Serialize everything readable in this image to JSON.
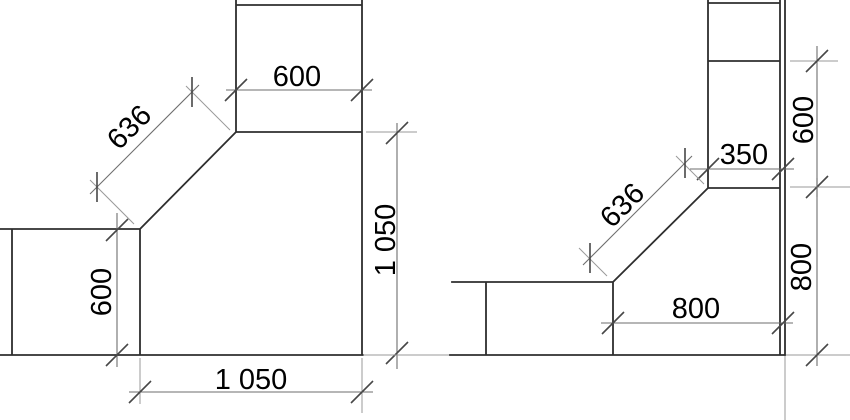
{
  "colors": {
    "background": "#ffffff",
    "object_line": "#2e2e2e",
    "dimension_line": "#6e6e6e",
    "tick": "#474747",
    "extension_line": "#9a9a9a",
    "text": "#000000"
  },
  "views": {
    "left": {
      "dims": {
        "top_width": "600",
        "diagonal": "636",
        "left_height": "600",
        "bottom_width": "1 050",
        "right_height": "1 050"
      }
    },
    "right": {
      "dims": {
        "column_width": "350",
        "diagonal": "636",
        "upper_right_height": "600",
        "lower_right_height": "800",
        "bottom_width": "800"
      }
    }
  }
}
